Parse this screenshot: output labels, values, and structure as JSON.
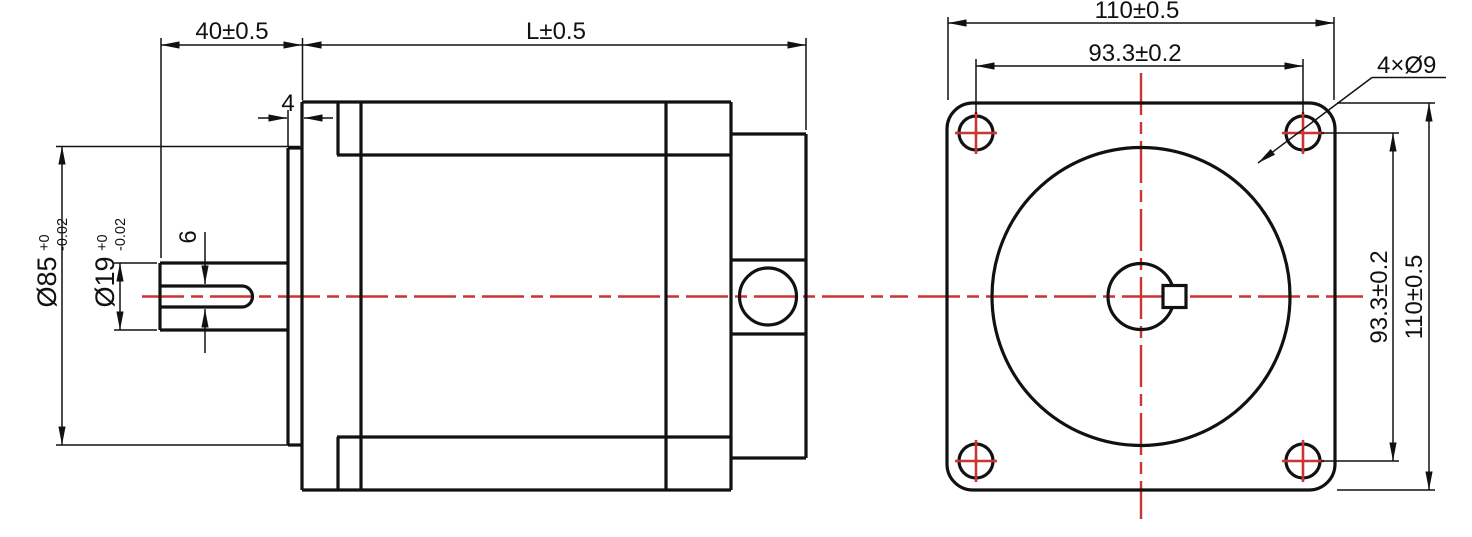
{
  "colors": {
    "line": "#111111",
    "centerline": "#cc3333",
    "background": "#ffffff"
  },
  "side_view": {
    "shaft_length": "40±0.5",
    "body_length": "L±0.5",
    "boss_protrusion": "4",
    "keyway_width": "6",
    "pilot_diameter": {
      "value": "Ø85",
      "tol_upper": "+0",
      "tol_lower": "-0.02"
    },
    "shaft_diameter": {
      "value": "Ø19",
      "tol_upper": "+0",
      "tol_lower": "-0.02"
    }
  },
  "front_view": {
    "flange_width": "110±0.5",
    "bolt_spacing_horizontal": "93.3±0.2",
    "mounting_holes": "4×Ø9",
    "bolt_spacing_vertical": "93.3±0.2",
    "flange_height": "110±0.5"
  }
}
